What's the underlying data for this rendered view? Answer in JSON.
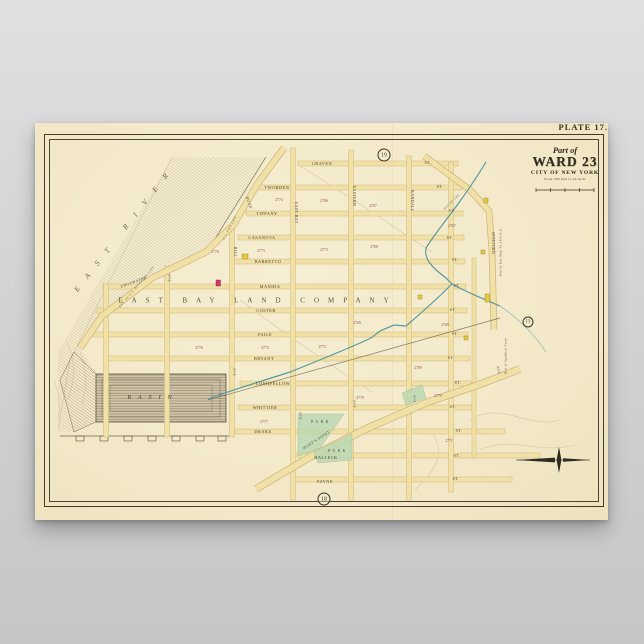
{
  "poster": {
    "plate_label": "PLATE 17.",
    "paper_color": "#f3e9c9",
    "title": {
      "part_of": "Part of",
      "ward": "WARD 23",
      "city": "CITY OF NEW YORK",
      "scale_note": "Scale 200 feet to an inch."
    }
  },
  "map": {
    "colors": {
      "street_fill": "#f1e1a6",
      "street_edge": "#c9b478",
      "creek": "#579aa0",
      "park": "#bcd9b4",
      "building_yellow": "#e8c93e",
      "building_red": "#cc3a66",
      "ink": "#4a4134"
    },
    "labels": [
      {
        "t": "CRAVEN",
        "x": 322,
        "y": 164,
        "n": "street-label"
      },
      {
        "t": "TWORDEN",
        "x": 277,
        "y": 188,
        "n": "street-label"
      },
      {
        "t": "TIFFANY",
        "x": 267,
        "y": 214,
        "n": "street-label"
      },
      {
        "t": "CASANOVA",
        "x": 262,
        "y": 238,
        "n": "street-label"
      },
      {
        "t": "BARRETTO",
        "x": 268,
        "y": 262,
        "n": "street-label"
      },
      {
        "t": "MANIDA",
        "x": 270,
        "y": 287,
        "n": "street-label"
      },
      {
        "t": "COSTER",
        "x": 266,
        "y": 311,
        "n": "street-label"
      },
      {
        "t": "FAILE",
        "x": 265,
        "y": 335,
        "n": "street-label"
      },
      {
        "t": "BRYANT",
        "x": 264,
        "y": 359,
        "n": "street-label"
      },
      {
        "t": "LONGFELLOW",
        "x": 273,
        "y": 384,
        "n": "street-label"
      },
      {
        "t": "WHITTIER",
        "x": 265,
        "y": 408,
        "n": "street-label"
      },
      {
        "t": "DRAKE",
        "x": 263,
        "y": 432,
        "n": "street-label"
      },
      {
        "t": "HALLECK",
        "x": 326,
        "y": 458,
        "n": "street-label"
      },
      {
        "t": "PAYNE",
        "x": 325,
        "y": 482,
        "n": "street-label"
      },
      {
        "t": "ST.",
        "x": 428,
        "y": 163,
        "fs": 4,
        "n": "street-suffix-label"
      },
      {
        "t": "ST.",
        "x": 440,
        "y": 187,
        "fs": 4,
        "n": "street-suffix-label"
      },
      {
        "t": "ST.",
        "x": 452,
        "y": 211,
        "fs": 4,
        "n": "street-suffix-label"
      },
      {
        "t": "ST.",
        "x": 450,
        "y": 238,
        "fs": 4,
        "n": "street-suffix-label"
      },
      {
        "t": "ST.",
        "x": 455,
        "y": 260,
        "fs": 4,
        "n": "street-suffix-label"
      },
      {
        "t": "ST.",
        "x": 457,
        "y": 286,
        "fs": 4,
        "n": "street-suffix-label"
      },
      {
        "t": "ST.",
        "x": 453,
        "y": 310,
        "fs": 4,
        "n": "street-suffix-label"
      },
      {
        "t": "ST.",
        "x": 455,
        "y": 334,
        "fs": 4,
        "n": "street-suffix-label"
      },
      {
        "t": "ST.",
        "x": 451,
        "y": 358,
        "fs": 4,
        "n": "street-suffix-label"
      },
      {
        "t": "ST.",
        "x": 458,
        "y": 383,
        "fs": 4,
        "n": "street-suffix-label"
      },
      {
        "t": "ST.",
        "x": 453,
        "y": 407,
        "fs": 4,
        "n": "street-suffix-label"
      },
      {
        "t": "ST.",
        "x": 459,
        "y": 431,
        "fs": 4,
        "n": "street-suffix-label"
      },
      {
        "t": "ST.",
        "x": 457,
        "y": 456,
        "fs": 4,
        "n": "street-suffix-label"
      },
      {
        "t": "ST.",
        "x": 456,
        "y": 479,
        "fs": 4,
        "n": "street-suffix-label"
      },
      {
        "t": "EAST BAY",
        "x": 295,
        "y": 213,
        "rot": 90,
        "fs": 3.8,
        "n": "avenue-label"
      },
      {
        "t": "EASTERN",
        "x": 353,
        "y": 196,
        "rot": 90,
        "fs": 3.8,
        "n": "avenue-label"
      },
      {
        "t": "RANDALL",
        "x": 411,
        "y": 201,
        "rot": 90,
        "fs": 3.8,
        "n": "avenue-label"
      },
      {
        "t": "HILL",
        "x": 234,
        "y": 252,
        "rot": 90,
        "fs": 3.8,
        "n": "avenue-label"
      },
      {
        "t": "SPOFFORD",
        "x": 492,
        "y": 243,
        "rot": 90,
        "fs": 3.6,
        "n": "avenue-label"
      },
      {
        "t": "AVE",
        "x": 169,
        "y": 278,
        "rot": 90,
        "fs": 3.4,
        "n": "avenue-label"
      },
      {
        "t": "AVE",
        "x": 234,
        "y": 372,
        "rot": 90,
        "fs": 3.4,
        "n": "avenue-label"
      },
      {
        "t": "AVE",
        "x": 300,
        "y": 416,
        "rot": 90,
        "fs": 3.4,
        "n": "avenue-label"
      },
      {
        "t": "AVE",
        "x": 354,
        "y": 404,
        "rot": 90,
        "fs": 3.4,
        "n": "avenue-label"
      },
      {
        "t": "AVE",
        "x": 414,
        "y": 399,
        "rot": 90,
        "fs": 3.4,
        "n": "avenue-label"
      },
      {
        "t": "AVE.",
        "x": 498,
        "y": 371,
        "rot": 75,
        "fs": 3.4,
        "n": "avenue-label"
      },
      {
        "t": "Bnd of Par Map 15 24th W.F.",
        "x": 501,
        "y": 252,
        "rot": -90,
        "fs": 3,
        "it": 1,
        "n": "boundary-note"
      },
      {
        "t": "Bnd of Spofford Farm",
        "x": 506,
        "y": 356,
        "rot": -90,
        "fs": 3,
        "it": 1,
        "n": "boundary-note"
      },
      {
        "t": "EAST RIVER",
        "x": 125,
        "y": 228,
        "rot": -52,
        "fs": 7.5,
        "ls": 12,
        "it": 1,
        "c": "#6f6553",
        "n": "water-label"
      },
      {
        "t": "BASIN",
        "x": 153,
        "y": 398,
        "fs": 6,
        "ls": 7,
        "it": 1,
        "c": "#3f382c",
        "n": "water-label"
      },
      {
        "t": "EXT. OF U.S. BULKHEAD LINE",
        "x": 137,
        "y": 287,
        "rot": -50,
        "fs": 3,
        "it": 1,
        "c": "#6f6553",
        "n": "shore-note"
      },
      {
        "t": "U.S. PIER LINE",
        "x": 230,
        "y": 228,
        "rot": -62,
        "fs": 3,
        "it": 1,
        "c": "#6f6553",
        "n": "shore-note"
      },
      {
        "t": "EDGEWATER",
        "x": 134,
        "y": 283,
        "rot": -20,
        "fs": 3.8,
        "n": "road-label"
      },
      {
        "t": "ROAD",
        "x": 248,
        "y": 203,
        "rot": 72,
        "fs": 3.8,
        "n": "road-label"
      },
      {
        "t": "HUNT'S POINT",
        "x": 317,
        "y": 441,
        "rot": -33,
        "fs": 3.8,
        "n": "road-label"
      },
      {
        "t": "PARK",
        "x": 321,
        "y": 423,
        "fs": 3.8,
        "ls": 2.5,
        "n": "park-label"
      },
      {
        "t": "PARK",
        "x": 338,
        "y": 452,
        "fs": 3.8,
        "ls": 2.5,
        "n": "park-label"
      },
      {
        "t": "BOUND CRK",
        "x": 452,
        "y": 202,
        "rot": -45,
        "fs": 3,
        "it": 1,
        "c": "#50706d",
        "n": "creek-label"
      },
      {
        "t": "EAST BAY LAND COMPANY",
        "x": 258,
        "y": 301,
        "fs": 7,
        "ls": 9,
        "c": "#55503f",
        "n": "land-company-label"
      }
    ],
    "numbers": [
      {
        "t": "2774",
        "x": 279,
        "y": 201
      },
      {
        "t": "2786",
        "x": 324,
        "y": 202
      },
      {
        "t": "2787",
        "x": 373,
        "y": 207
      },
      {
        "t": "2767",
        "x": 452,
        "y": 227
      },
      {
        "t": "2788",
        "x": 374,
        "y": 248
      },
      {
        "t": "2776",
        "x": 215,
        "y": 253
      },
      {
        "t": "2773",
        "x": 261,
        "y": 252
      },
      {
        "t": "2773",
        "x": 324,
        "y": 251
      },
      {
        "t": "2769",
        "x": 357,
        "y": 324
      },
      {
        "t": "2769",
        "x": 445,
        "y": 326
      },
      {
        "t": "2776",
        "x": 199,
        "y": 349
      },
      {
        "t": "2773",
        "x": 265,
        "y": 349
      },
      {
        "t": "2773",
        "x": 322,
        "y": 348
      },
      {
        "t": "2769",
        "x": 418,
        "y": 369
      },
      {
        "t": "2770",
        "x": 360,
        "y": 399
      },
      {
        "t": "2770",
        "x": 438,
        "y": 397
      },
      {
        "t": "2777",
        "x": 264,
        "y": 423
      },
      {
        "t": "2771",
        "x": 449,
        "y": 442
      }
    ],
    "circles": [
      {
        "t": "19",
        "x": 384,
        "y": 155,
        "d": 11
      },
      {
        "t": "18",
        "x": 324,
        "y": 499,
        "d": 11
      },
      {
        "t": "13",
        "x": 528,
        "y": 322,
        "d": 9
      }
    ]
  }
}
